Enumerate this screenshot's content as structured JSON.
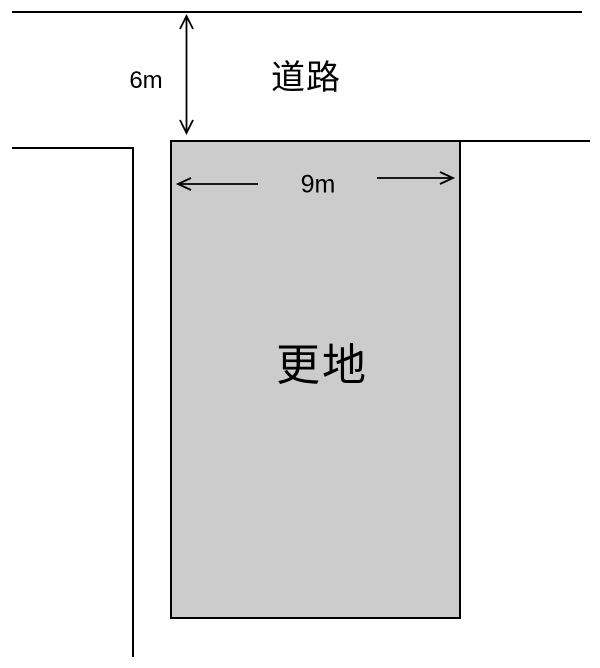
{
  "diagram": {
    "type": "land-plot-site-plan",
    "labels": {
      "road": "道路",
      "road_width": "6m",
      "plot": "更地",
      "plot_frontage": "9m"
    },
    "colors": {
      "plot_fill": "#cccccc",
      "line": "#000000",
      "background": "#ffffff"
    }
  }
}
